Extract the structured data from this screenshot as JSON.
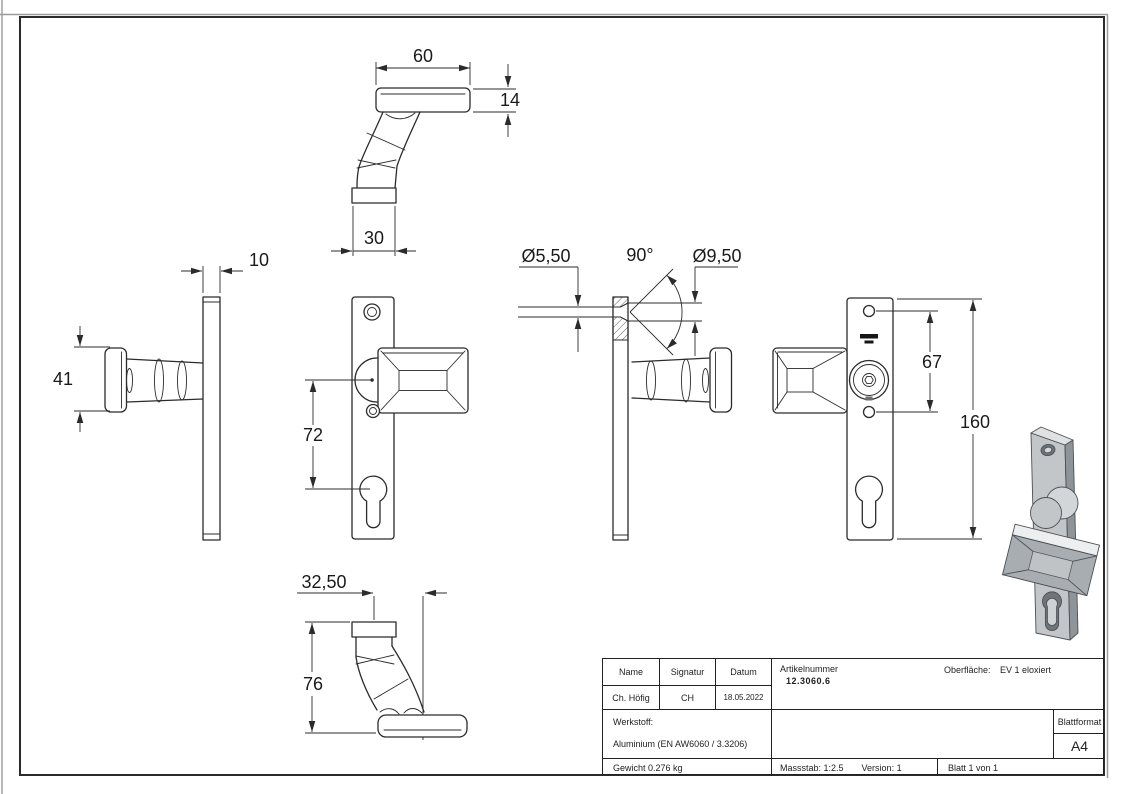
{
  "dims": {
    "top": {
      "width": "60",
      "thickness": "14",
      "base": "30"
    },
    "left": {
      "plate": "10",
      "grip": "41"
    },
    "front": {
      "spacing": "72"
    },
    "section": {
      "bore": "Ø5,50",
      "angle": "90°",
      "csk": "Ø9,50"
    },
    "back": {
      "holes": "67",
      "height": "160"
    },
    "bottom": {
      "offset": "32,50",
      "depth": "76"
    }
  },
  "title_block": {
    "name_label": "Name",
    "signatur_label": "Signatur",
    "datum_label": "Datum",
    "name_value": "Ch. Höfig",
    "signatur_value": "CH",
    "datum_value": "18.05.2022",
    "artikelnummer_label": "Artikelnummer",
    "artikelnummer_value": "12.3060.6",
    "oberflaeche_label": "Oberfläche:",
    "oberflaeche_value": "EV 1 eloxiert",
    "werkstoff_label": "Werkstoff:",
    "werkstoff_value": "Aluminium (EN AW6060 / 3.3206)",
    "blattformat_label": "Blattformat",
    "blattformat_value": "A4",
    "gewicht_value": "Gewicht 0.276 kg",
    "massstab_value": "Massstab: 1:2.5",
    "version_value": "Version: 1",
    "blatt_value": "Blatt 1 von 1"
  },
  "colors": {
    "line": "#2b2b2b",
    "shade_light": "#e0e2e4",
    "shade_mid": "#bfc3c6",
    "shade_dark": "#8f9498"
  }
}
